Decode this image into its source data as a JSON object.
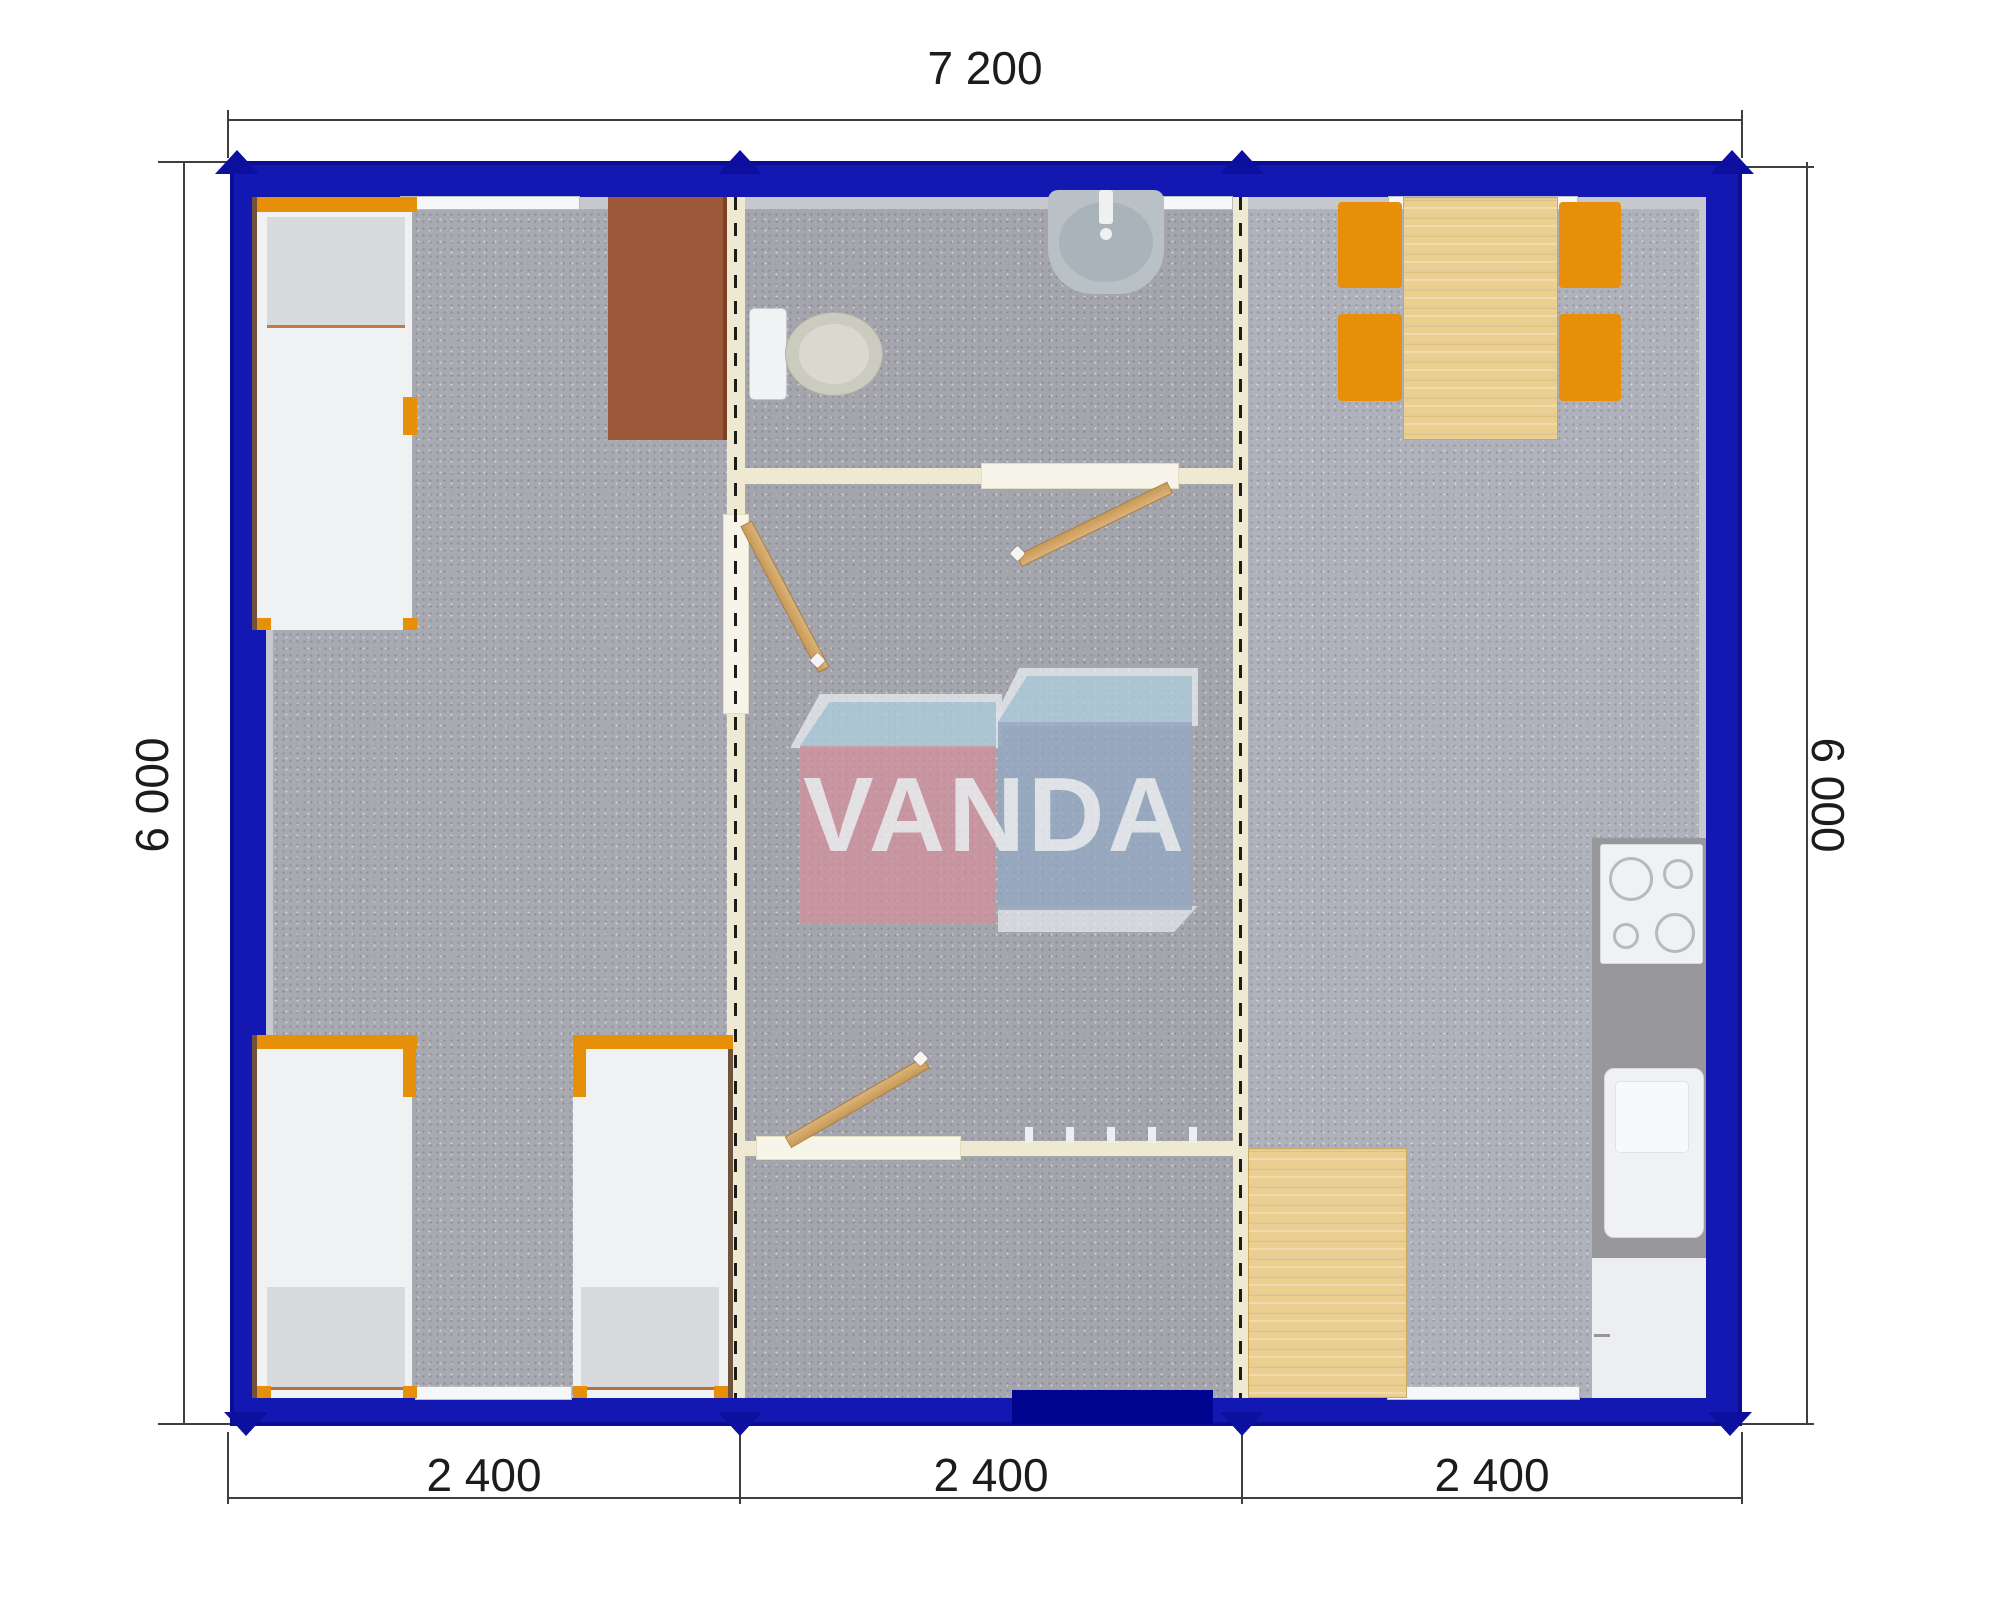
{
  "plan": {
    "type": "modular-building-floor-plan",
    "dimensions": {
      "top": "7 200",
      "left": "6 000",
      "right": "6 000",
      "bottom": [
        "2 400",
        "2 400",
        "2 400"
      ]
    },
    "watermark": {
      "text": "VANDA"
    },
    "colors": {
      "exterior_wall_blue": "#1418b2",
      "exterior_wall_shadow": "#0b0d92",
      "module_marker_navy": "#0d0f9e",
      "interior_wall_cream": "#efe9d2",
      "floor_gray_left": "#a9a9b1",
      "floor_gray_middle": "#a5a5ad",
      "floor_gray_right": "#afb1bb",
      "furniture_orange": "#e78f09",
      "wood_light": "#eacf90",
      "door_wood": "#d2a768",
      "desk_brown": "#9d5939",
      "counter_gray": "#98989c",
      "watermark_pink": "#d5909b",
      "watermark_blue": "#94aac4",
      "watermark_light_blue": "#a8cbda"
    },
    "furniture": [
      "bed",
      "bed",
      "bed",
      "desk",
      "toilet",
      "wash-basin",
      "dining-table",
      "chair",
      "chair",
      "chair",
      "chair",
      "kitchen-counter",
      "cooktop",
      "kitchen-sink",
      "base-cabinet",
      "kitchen-table"
    ]
  }
}
